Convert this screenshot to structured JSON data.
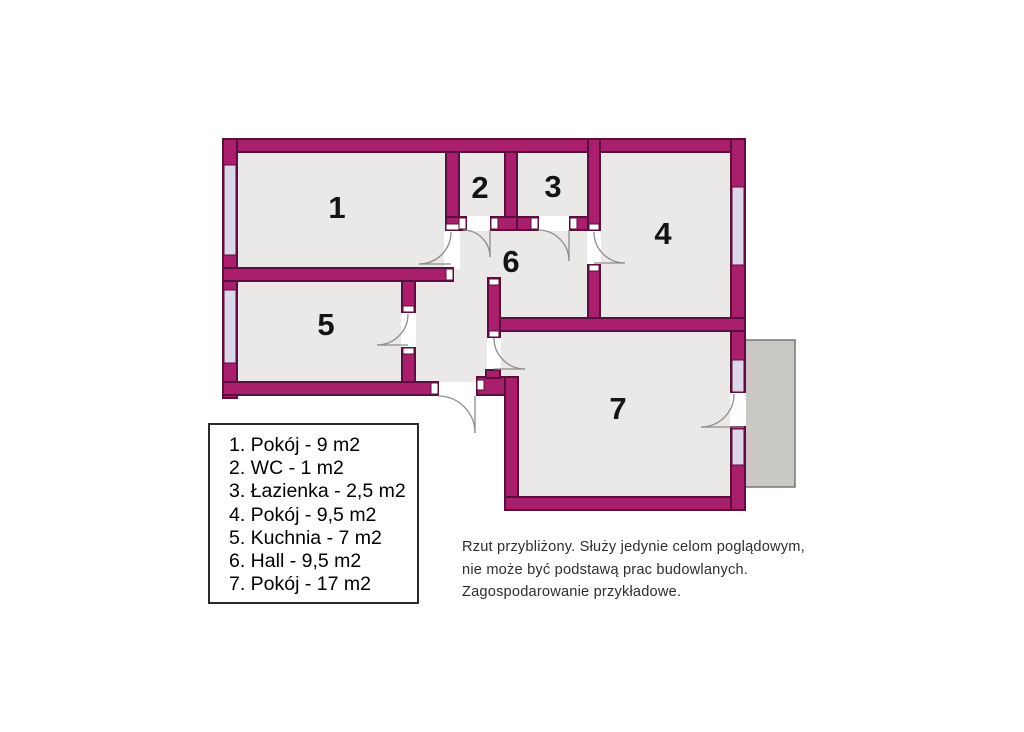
{
  "plan": {
    "title": "apartment-floor-plan",
    "rooms": [
      {
        "number": "1"
      },
      {
        "number": "2"
      },
      {
        "number": "3"
      },
      {
        "number": "4"
      },
      {
        "number": "5"
      },
      {
        "number": "6"
      },
      {
        "number": "7"
      }
    ]
  },
  "legend": {
    "items": [
      "1. Pokój - 9 m2",
      "2. WC - 1 m2",
      "3. Łazienka - 2,5 m2",
      "4. Pokój - 9,5 m2",
      "5. Kuchnia - 7 m2",
      "6. Hall - 9,5 m2",
      "7. Pokój - 17 m2"
    ]
  },
  "disclaimer": {
    "lines": [
      "Rzut przybliżony. Służy jedynie celom poglądowym,",
      "nie może być podstawą prac budowlanych.",
      "Zagospodarowanie przykładowe."
    ]
  },
  "colors": {
    "background": "#FFFFFF",
    "wall": "#AA1F6B",
    "wall_edge": "#5C0E3F",
    "floor": "#EBE9E7",
    "window": "#DCD8EA",
    "balcony": "#C9C8C5",
    "balcony_edge": "#767674",
    "door_arc": "#8D8D8D",
    "text": "#141414"
  }
}
